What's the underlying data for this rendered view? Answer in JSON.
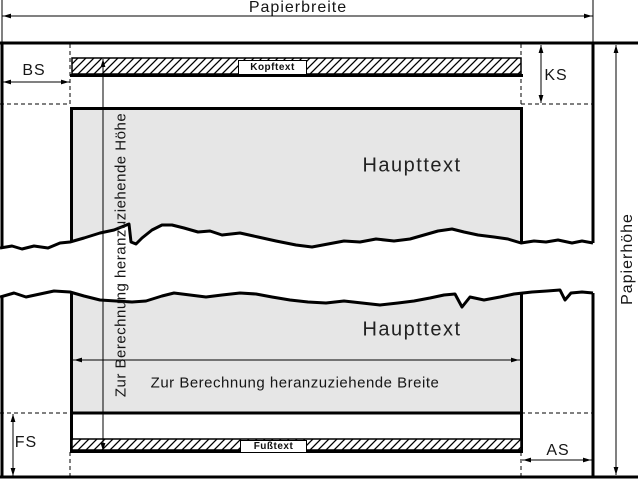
{
  "labels": {
    "paper_width": "Papierbreite",
    "paper_height": "Papierhöhe",
    "margin_left": "BS",
    "margin_header": "KS",
    "margin_footer": "FS",
    "margin_right": "AS",
    "header": "Kopftext",
    "footer": "Fußtext",
    "body_top": "Haupttext",
    "body_bottom": "Haupttext",
    "calc_height": "Zur Berechnung heranzuziehende Höhe",
    "calc_width": "Zur Berechnung heranzuziehende Breite"
  },
  "colors": {
    "line": "#000000",
    "body_fill": "#e6e6e6",
    "background": "#ffffff"
  }
}
